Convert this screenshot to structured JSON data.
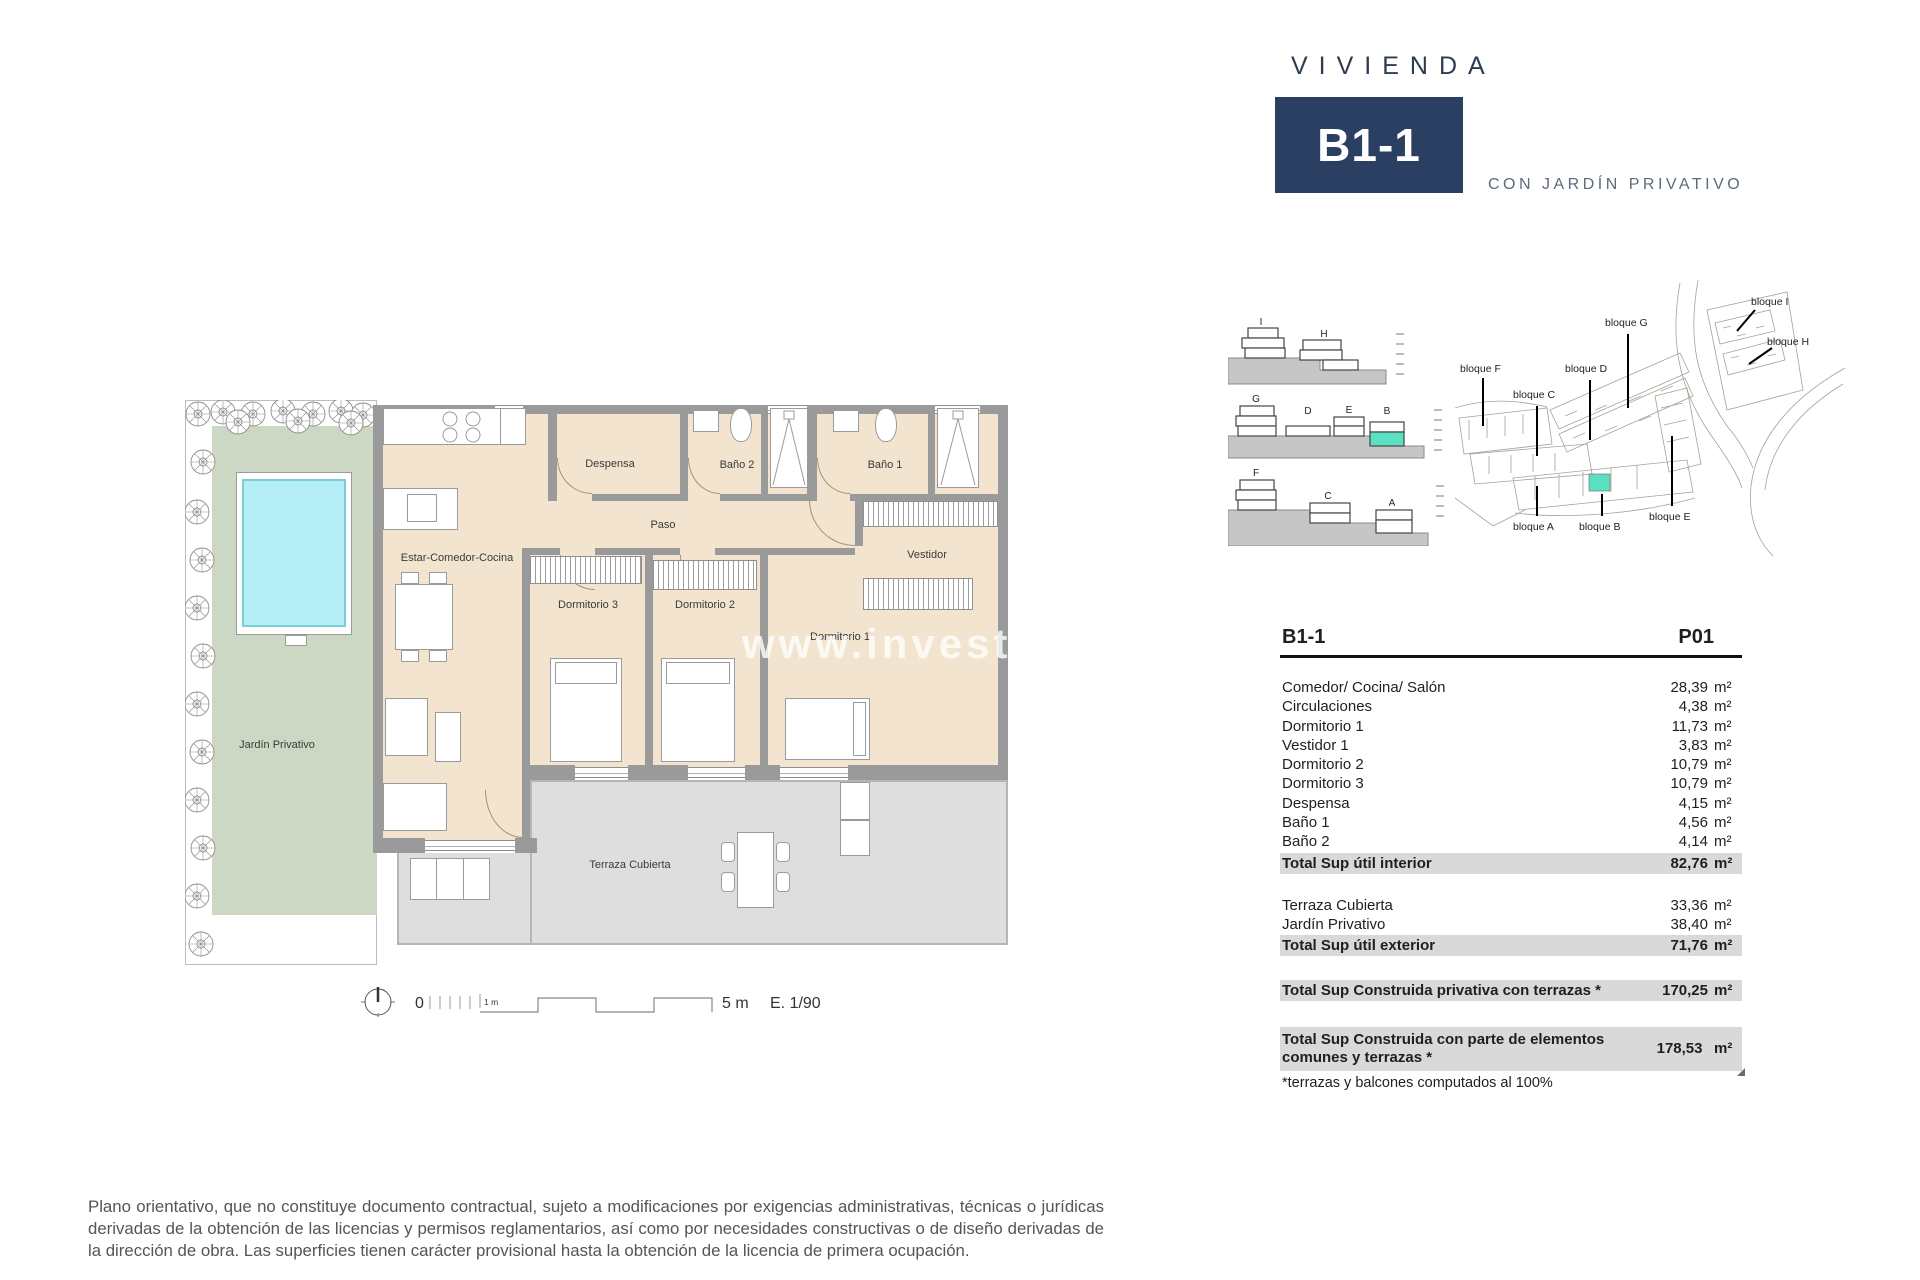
{
  "title": {
    "kicker": "VIVIENDA",
    "unit": "B1-1",
    "subtitle": "CON JARDÍN PRIVATIVO"
  },
  "colors": {
    "navy": "#2b3f63",
    "titlegray": "#5c6b7c",
    "teal": "#5ce0c2",
    "beige": "#f2e4cf",
    "wall": "#9a9a9a",
    "wallLight": "#b5b5b5",
    "garden": "#ccd8c3",
    "pool": "#b5eef5",
    "poolEdge": "#79cdd9",
    "terrace": "#dedede",
    "rowGray": "#d9d9d9",
    "ink": "#1f1f1f",
    "textGray": "#555555"
  },
  "plan": {
    "rooms": {
      "estar": "Estar-Comedor-Cocina",
      "despensa": "Despensa",
      "bano2": "Baño 2",
      "bano1": "Baño 1",
      "paso": "Paso",
      "vestidor": "Vestidor",
      "dorm3": "Dormitorio 3",
      "dorm2": "Dormitorio 2",
      "dorm1": "Dormitorio 1",
      "jardin": "Jardín Privativo",
      "terraza": "Terraza Cubierta"
    },
    "watermark": "www.investf",
    "scale": {
      "zero": "0",
      "one_m": "1 m",
      "five_m": "5 m",
      "ratio": "E. 1/90"
    }
  },
  "elevations": {
    "row1": [
      "I",
      "H"
    ],
    "row2": [
      "G",
      "D",
      "E",
      "B"
    ],
    "row3": [
      "F",
      "C",
      "A"
    ]
  },
  "siteplan": {
    "labels": {
      "f": "bloque F",
      "c": "bloque C",
      "d": "bloque D",
      "g": "bloque G",
      "i": "bloque I",
      "h": "bloque H",
      "a": "bloque A",
      "b": "bloque B",
      "e": "bloque E"
    }
  },
  "table": {
    "col_left": "B1-1",
    "col_right": "P01",
    "unit": "m²",
    "interior": [
      [
        "Comedor/ Cocina/ Salón",
        "28,39"
      ],
      [
        "Circulaciones",
        "4,38"
      ],
      [
        "Dormitorio 1",
        "11,73"
      ],
      [
        "Vestidor 1",
        "3,83"
      ],
      [
        "Dormitorio 2",
        "10,79"
      ],
      [
        "Dormitorio 3",
        "10,79"
      ],
      [
        "Despensa",
        "4,15"
      ],
      [
        "Baño 1",
        "4,56"
      ],
      [
        "Baño 2",
        "4,14"
      ]
    ],
    "total_interior": [
      "Total Sup útil interior",
      "82,76"
    ],
    "exterior": [
      [
        "Terraza Cubierta",
        "33,36"
      ],
      [
        "Jardín Privativo",
        "38,40"
      ]
    ],
    "total_exterior": [
      "Total Sup útil exterior",
      "71,76"
    ],
    "total_privativa": [
      "Total Sup Construida privativa con terrazas *",
      "170,25"
    ],
    "total_comunes": [
      "Total Sup Construida con parte de elementos comunes y terrazas *",
      "178,53"
    ],
    "footnote": "*terrazas y balcones computados al 100%"
  },
  "disclaimer": "Plano orientativo, que no constituye documento contractual, sujeto a modificaciones por exigencias administrativas, técnicas o jurídicas derivadas de la obtención de las licencias y permisos reglamentarios, así como por necesidades constructivas o de diseño derivadas de la dirección de obra. Las superficies tienen carácter provisional hasta la obtención de la licencia de primera ocupación."
}
